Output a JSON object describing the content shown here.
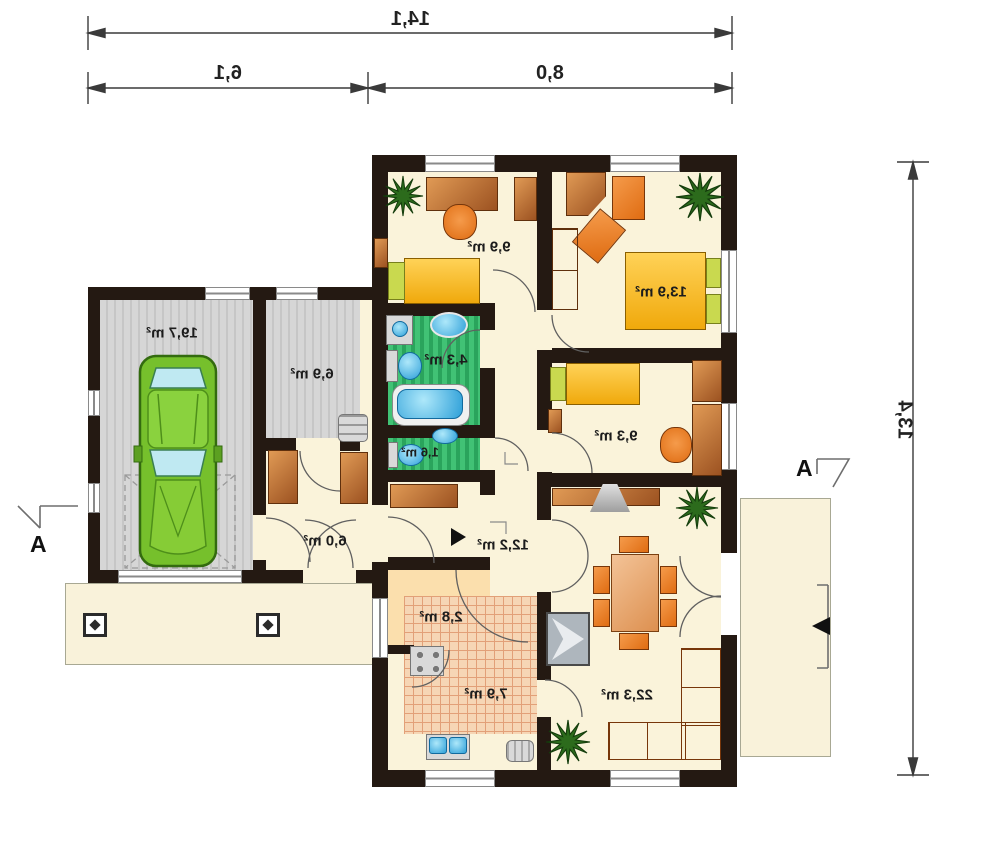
{
  "dimensions": {
    "total_width": "14,1",
    "left_segment": "6,1",
    "right_segment": "8,0",
    "side_height": "13,4"
  },
  "room_areas": {
    "garage": "19,7 m²",
    "utility_room": "6,9 m²",
    "bedroom_top_left": "9,9 m²",
    "bedroom_top_right": "13,9 m²",
    "bathroom": "4,3 m²",
    "wc": "1,6 m²",
    "bedroom_right": "9,3 m²",
    "entry_hall": "6,0 m²",
    "corridor": "12,2 m²",
    "pantry": "2,8 m²",
    "kitchen": "7,9 m²",
    "living_room": "22,3 m²"
  },
  "section_markers": {
    "left": "A",
    "right": "A"
  },
  "colors": {
    "wall": "#241912",
    "floor_cream": "#faf3da",
    "floor_garage": "#d2d2d2",
    "floor_wet_green": "#3cbb6c",
    "floor_kitchen": "#f6d6b5",
    "floor_pantry": "#fbdfad",
    "furniture_wood": "#c87a38",
    "furniture_orange": "#ea7d1f",
    "bed_yellow": "#f5b81e",
    "pillow_lime": "#c9d94f",
    "fixture_blue": "#3fc1ee",
    "car_green": "#76c02c",
    "plant_green": "#2c6b1c",
    "dimension_line": "#3a3a3a"
  }
}
